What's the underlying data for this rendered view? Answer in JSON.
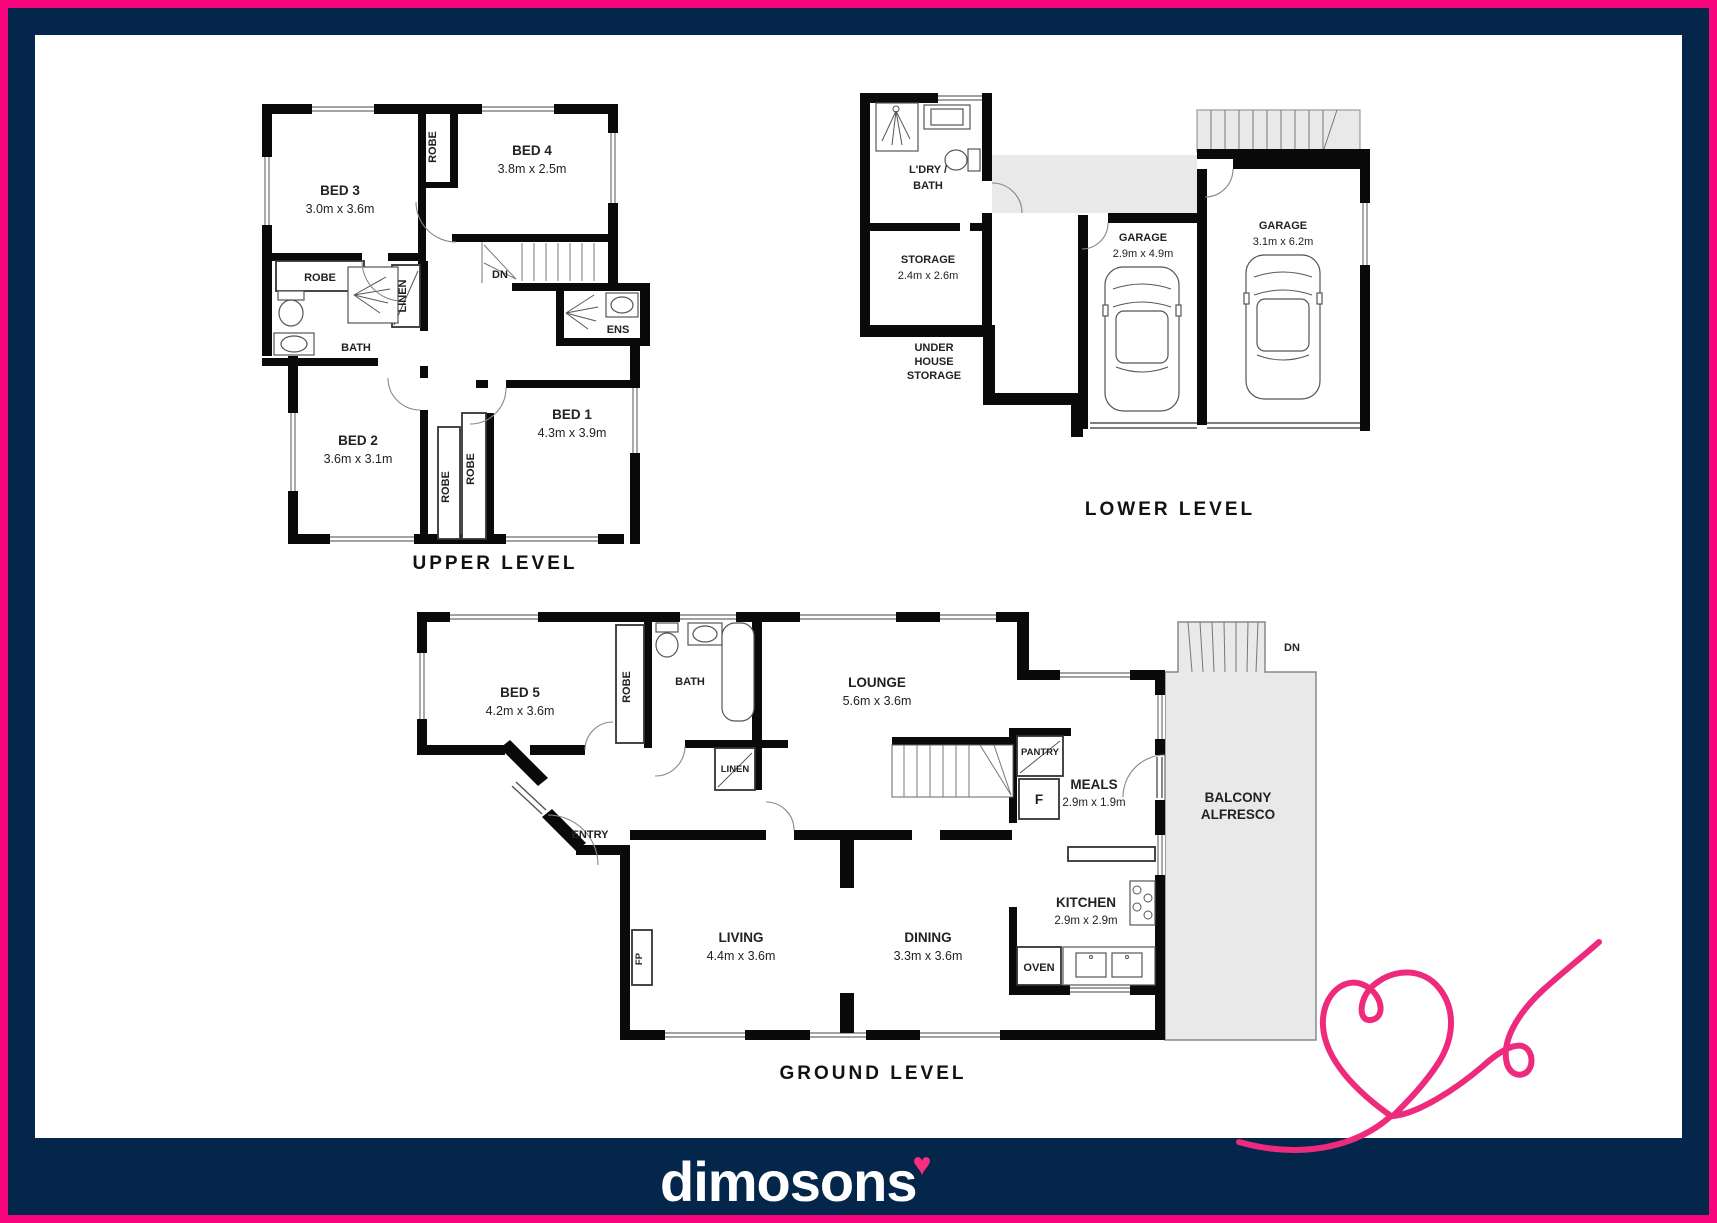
{
  "brand": {
    "logo": "dimosons",
    "heart": "♥"
  },
  "colors": {
    "pink": "#f7057d",
    "navy": "#04264a",
    "plan_gray": "#e9e9e9"
  },
  "shared": {
    "robe": "ROBE",
    "linen": "LINEN",
    "bath": "BATH",
    "dn": "DN",
    "garage": "GARAGE"
  },
  "upper": {
    "title": "UPPER LEVEL",
    "bed1": "BED 1",
    "bed1_dims": "4.3m x 3.9m",
    "bed2": "BED 2",
    "bed2_dims": "3.6m x 3.1m",
    "bed3": "BED 3",
    "bed3_dims": "3.0m x 3.6m",
    "bed4": "BED 4",
    "bed4_dims": "3.8m x 2.5m",
    "ens": "ENS"
  },
  "lower": {
    "title": "LOWER LEVEL",
    "ldry_line1": "L'DRY /",
    "storage": "STORAGE",
    "storage_dims": "2.4m x 2.6m",
    "under_line1": "UNDER",
    "under_line2": "HOUSE",
    "under_line3": "STORAGE",
    "garage1_dims": "2.9m x 4.9m",
    "garage2_dims": "3.1m x 6.2m"
  },
  "ground": {
    "title": "GROUND LEVEL",
    "bed5": "BED 5",
    "bed5_dims": "4.2m x 3.6m",
    "lounge": "LOUNGE",
    "lounge_dims": "5.6m x 3.6m",
    "meals": "MEALS",
    "meals_dims": "2.9m x 1.9m",
    "kitchen": "KITCHEN",
    "kitchen_dims": "2.9m x 2.9m",
    "living": "LIVING",
    "living_dims": "4.4m x 3.6m",
    "dining": "DINING",
    "dining_dims": "3.3m x 3.6m",
    "balcony_line1": "BALCONY",
    "balcony_line2": "ALFRESCO",
    "entry": "ENTRY",
    "pantry": "PANTRY",
    "fridge": "F",
    "oven": "OVEN",
    "fp": "FP"
  }
}
